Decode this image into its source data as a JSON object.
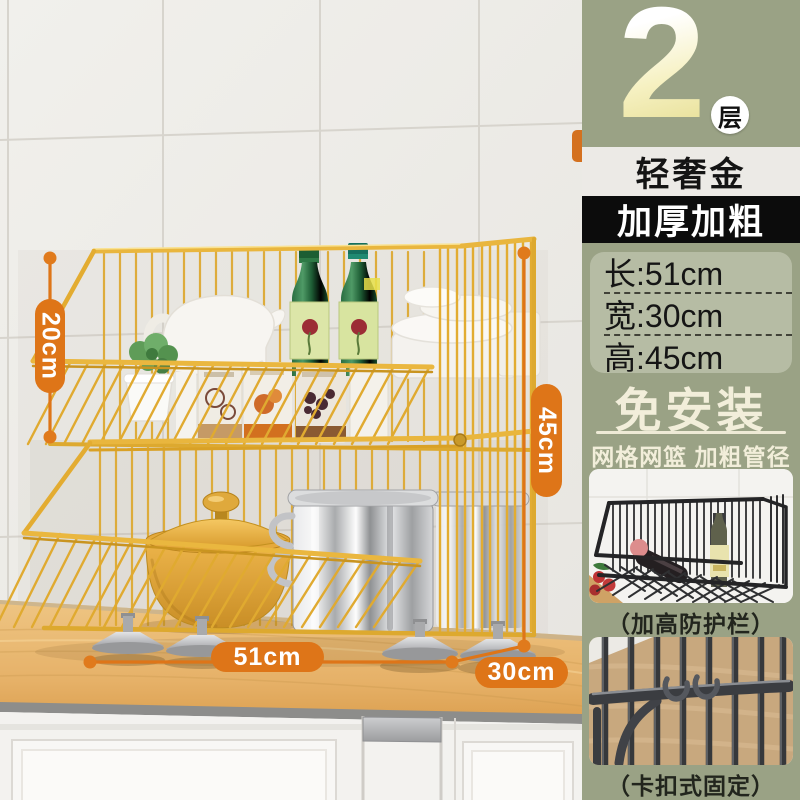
{
  "annotations": {
    "accent_color": "#de7518",
    "upper_height": "20cm",
    "total_height": "45cm",
    "length": "51cm",
    "depth": "30cm"
  },
  "panel": {
    "bg_color": "#9aa285",
    "tier_number": "2",
    "tier_unit": "层",
    "color_name": "轻奢金",
    "feature_badge": "加厚加粗",
    "dimensions": {
      "rows": [
        "长:51cm",
        "宽:30cm",
        "高:45cm"
      ]
    },
    "headline": "免安装",
    "subheadline": "网格网篮 加粗管径",
    "photos": [
      {
        "caption": "（加高防护栏）"
      },
      {
        "caption": "（卡扣式固定）"
      }
    ]
  }
}
